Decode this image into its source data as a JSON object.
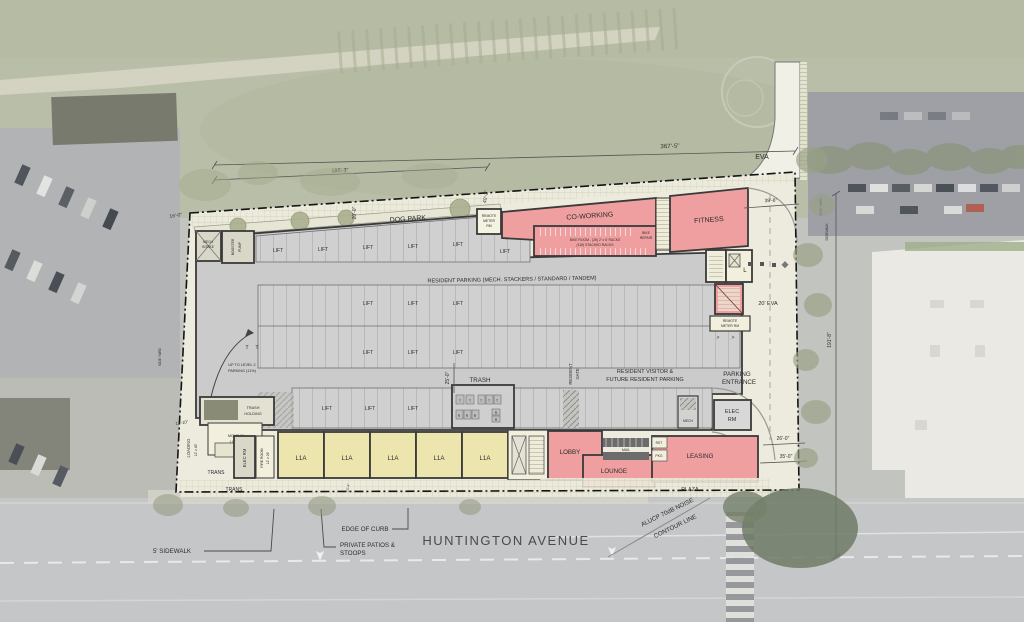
{
  "plan": {
    "street_name": "HUNTINGTON AVENUE",
    "colors": {
      "amenity_pink": "#ef9f9f",
      "unit_yellow": "#ece5ae",
      "parking_grey": "#cbcbcb",
      "site_cream": "#edebdd",
      "wall": "#3a3a3a"
    }
  },
  "labels": {
    "dog_park": "DOG PARK",
    "co_working": "CO-WORKING",
    "fitness": "FITNESS",
    "bike_room_1": "BIKE ROOM - (26) 2' x 6' RACKS",
    "bike_room_2": "(115) STACKED RACKS",
    "bike_repair_1": "BIKE",
    "bike_repair_2": "REPAIR",
    "remote_1": "REMOTE",
    "remote_2": "METER",
    "remote_3": "RM",
    "remote2_1": "REMOTE",
    "remote2_2": "METER RM",
    "resident_parking": "RESIDENT PARKING (MECH. STACKERS / STANDARD / TANDEM)",
    "resident_visitor_1": "RESIDENT VISITOR &",
    "resident_visitor_2": "FUTURE RESIDENT PARKING",
    "parking_entrance_1": "PARKING",
    "parking_entrance_2": "ENTRANCE",
    "resident_gate_1": "RESIDENT",
    "resident_gate_2": "GATE",
    "trash": "TRASH",
    "trash_holding_1": "TRASH",
    "trash_holding_2": "HOLDING",
    "move_in_1": "MOVE-IN",
    "move_in_2": "LOBBY",
    "elec_rm": "ELEC RM",
    "elec_1": "ELEC",
    "elec_2": "RM",
    "fire_room_1": "FIRE ROOM",
    "fire_room_2": "12' x 26'",
    "mech_intake_1": "MECH",
    "mech_intake_2": "INTAKE",
    "booster_1": "BOOSTER",
    "booster_2": "PUMP",
    "up_level_1": "UP TO LEVEL 2",
    "up_level_2": "PARKING (11%)",
    "lift": "LIFT",
    "unit": "L1A",
    "lobby": "LOBBY",
    "lounge": "LOUNGE",
    "leasing": "LEASING",
    "mail": "MAIL",
    "mech": "MECH",
    "rst": "RST",
    "pkg": "PKG",
    "plaza": "PLAZA",
    "trans": "TRANS",
    "loading_1": "LOADING",
    "loading_2": "12' x 45'",
    "eva": "EVA",
    "eva20": "20' EVA",
    "l_room": "L",
    "side_yard": "SIDE YARD",
    "sidewalk": "SIDEWALK",
    "edge_of_curb": "EDGE OF CURB",
    "patios_1": "PRIVATE PATIOS &",
    "patios_2": "STOOPS",
    "sidewalk5": "5' SIDEWALK",
    "alucp_1": "ALUCP 70dB NOISE",
    "alucp_2": "CONTOUR LINE",
    "t": "T",
    "r": "R",
    "chevron": ">"
  },
  "dimensions": {
    "d367": "367'-5\"",
    "d185": "185'-3\"",
    "d16": "16'-0\"",
    "d20": "20'-0\"",
    "d40": "40'-2\"",
    "d39": "39'-6\"",
    "d191": "191'-8\"",
    "d26": "26'-0\"",
    "d35": "35'-0\"",
    "d25": "25'-0\"",
    "d12_10": "12'-10\"",
    "d13_4": "13'-4\""
  }
}
